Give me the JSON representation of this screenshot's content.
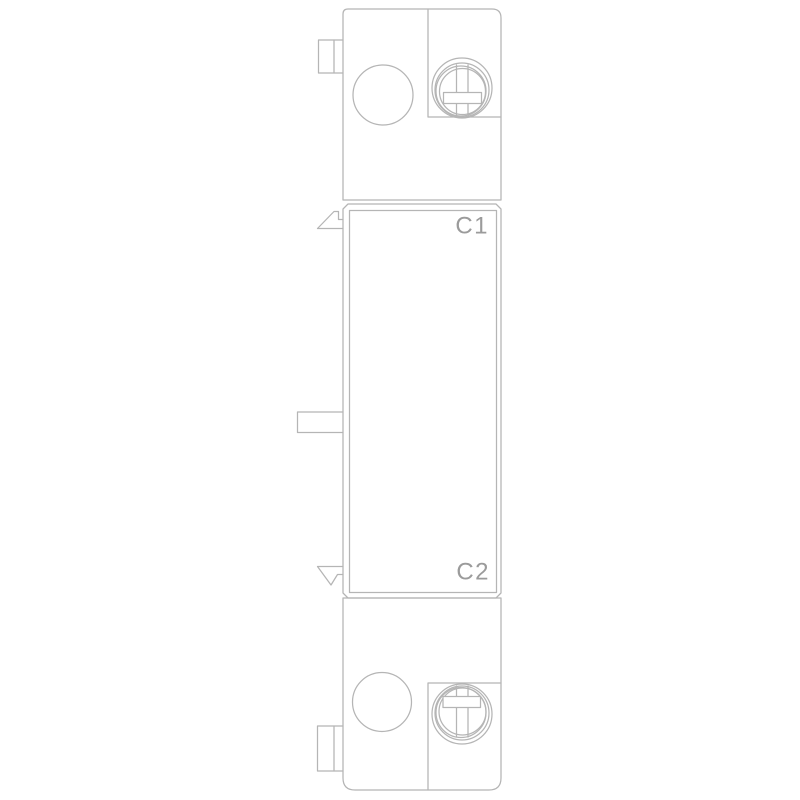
{
  "drawing": {
    "description": "monochrome technical line drawing of a tall narrow electrical accessory module with screw terminals top and bottom",
    "labels": {
      "c1": "C1",
      "c2": "C2"
    },
    "colors": {
      "line": "#b5b5b5",
      "label": "#9b9b9b",
      "background": "#ffffff"
    }
  }
}
